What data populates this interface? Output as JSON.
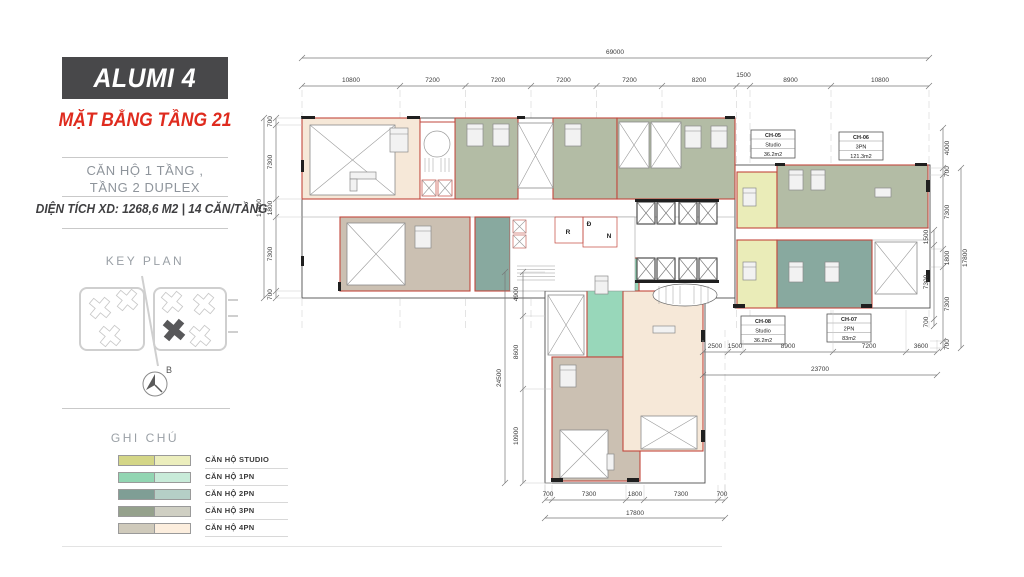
{
  "sidebar": {
    "title": "ALUMI 4",
    "subtitle": "MẶT BẰNG TẦNG 21",
    "description_line1": "CĂN HỘ 1 TẦNG ,",
    "description_line2": "TẦNG 2 DUPLEX",
    "area_info": "DIỆN TÍCH XD: 1268,6 M2  |  14 CĂN/TẦNG",
    "key_plan": {
      "label": "KEY PLAN",
      "compass_label": "B"
    },
    "legend": {
      "title": "GHI CHÚ",
      "items": [
        {
          "label": "CĂN HỘ STUDIO",
          "color_dark": "#d4d687",
          "color_light": "#eceebd"
        },
        {
          "label": "CĂN HỘ 1PN",
          "color_dark": "#92d5b2",
          "color_light": "#c8ebd9"
        },
        {
          "label": "CĂN HỘ 2PN",
          "color_dark": "#7f9e95",
          "color_light": "#b5cfc6"
        },
        {
          "label": "CĂN HỘ 3PN",
          "color_dark": "#95a18c",
          "color_light": "#cfcfc3"
        },
        {
          "label": "CĂN HỘ 4PN",
          "color_dark": "#cfcabb",
          "color_light": "#fceede"
        }
      ]
    }
  },
  "plan": {
    "palette": {
      "outline_red": "#c2473d",
      "studio": "#eaecb8",
      "pn1": "#98d7ba",
      "pn2": "#88a99f",
      "pn3": "#b3bca5",
      "pn4_dark": "#cbc0b2",
      "pn4_light": "#f6e8d8",
      "accent_red": "#df2b1e",
      "header_bg": "#48484a"
    },
    "units": [
      {
        "id": "CH-05",
        "type": "Studio",
        "area": "36.2m2"
      },
      {
        "id": "CH-06",
        "type": "3PN",
        "area": "121.3m2"
      },
      {
        "id": "CH-07",
        "type": "2PN",
        "area": "83m2"
      },
      {
        "id": "CH-08",
        "type": "Studio",
        "area": "36.2m2"
      }
    ],
    "core_rooms": {
      "r": "R",
      "d": "Đ",
      "n": "N"
    },
    "dimensions": {
      "top_total": "69000",
      "top_segments": [
        "10800",
        "7200",
        "7200",
        "7200",
        "7200",
        "8200",
        "1500",
        "8900",
        "10800"
      ],
      "left_total": "17800",
      "left_segments": [
        "700",
        "7300",
        "1800",
        "7300",
        "700"
      ],
      "right_top": "4000",
      "right_total": "17800",
      "right_segments": [
        "700",
        "7300",
        "1800",
        "7300",
        "700"
      ],
      "right_inner_segments": [
        "1500",
        "7300",
        "700"
      ],
      "bottom_total": "17800",
      "bottom_segments": [
        "700",
        "7300",
        "1800",
        "7300",
        "700"
      ],
      "bottom_right_total": "23700",
      "bottom_right_segments": [
        "2500",
        "1500",
        "8900",
        "7200",
        "3600"
      ],
      "wing_left_total": "24500",
      "wing_left_segments": [
        "4900",
        "8600",
        "10900"
      ]
    }
  }
}
